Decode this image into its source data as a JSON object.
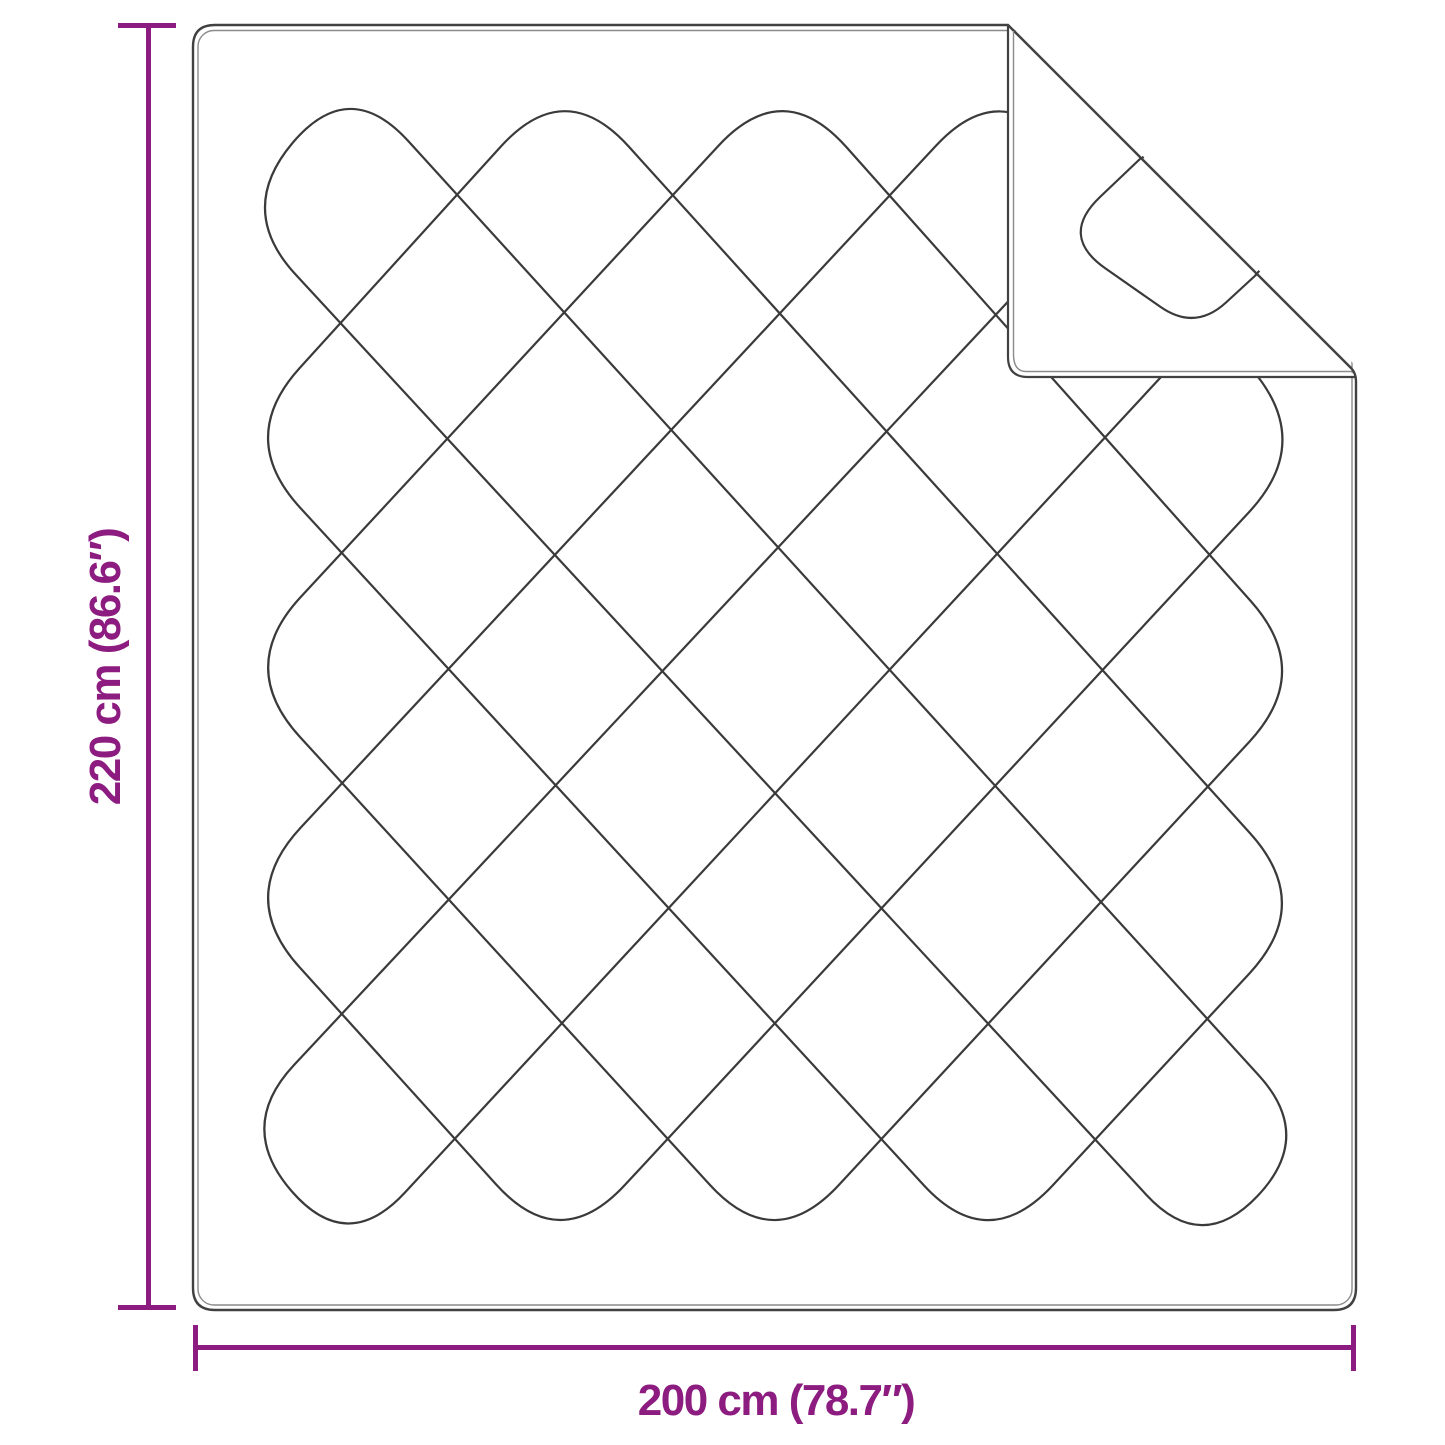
{
  "page": {
    "background": "#ffffff"
  },
  "diagram": {
    "accent_color": "#8C1C7F",
    "line_color": "#3A3A3A",
    "outline_color": "#414141",
    "seam_color": "#8A8A8A",
    "blanket": {
      "body": {
        "left": 193,
        "top": 25,
        "right": 1356,
        "bottom": 1310,
        "corner_radius": 22,
        "notch_x": 1008,
        "crease_end_x": 1351.5,
        "crease_end_y": 368.5,
        "right_edge_top_y": 381
      },
      "seam": {
        "left": 198,
        "top": 30.5,
        "right": 1352,
        "bottom": 1305,
        "radius": 16,
        "width": 1.4
      },
      "flap": {
        "leg_x": 1008,
        "top_y": 25,
        "bottom_y": 377,
        "tip_x": 1356,
        "corner_radius": 20,
        "seam_offset": 5.5,
        "quilt_curve": [
          [
            1141,
            158
          ],
          [
            1059,
            236
          ],
          [
            1195,
            331
          ],
          [
            1257,
            274
          ]
        ]
      }
    },
    "quilt": {
      "top_xs": [
        349,
        565,
        783,
        1001,
        1219
      ],
      "bottom_xs": [
        347,
        560,
        774,
        988,
        1202
      ],
      "left_ys": [
        210,
        438,
        667,
        897,
        1127
      ],
      "right_ys": [
        212,
        442,
        672,
        904,
        1136
      ],
      "top_vertex_y": 76,
      "bottom_vertex_y": 1255,
      "left_vertex_x": 236,
      "right_vertex_x": 1314,
      "corner_round": 95,
      "stroke_width": 2.2,
      "mask_triangle": "1008,23 1363,23 1363,373"
    },
    "dimensions": {
      "height": {
        "label": "220 cm (86.6″)",
        "value_cm": "220",
        "value_inch": "86.6"
      },
      "width": {
        "label": "200 cm (78.7″)",
        "value_cm": "200",
        "value_inch": "78.7"
      }
    }
  }
}
